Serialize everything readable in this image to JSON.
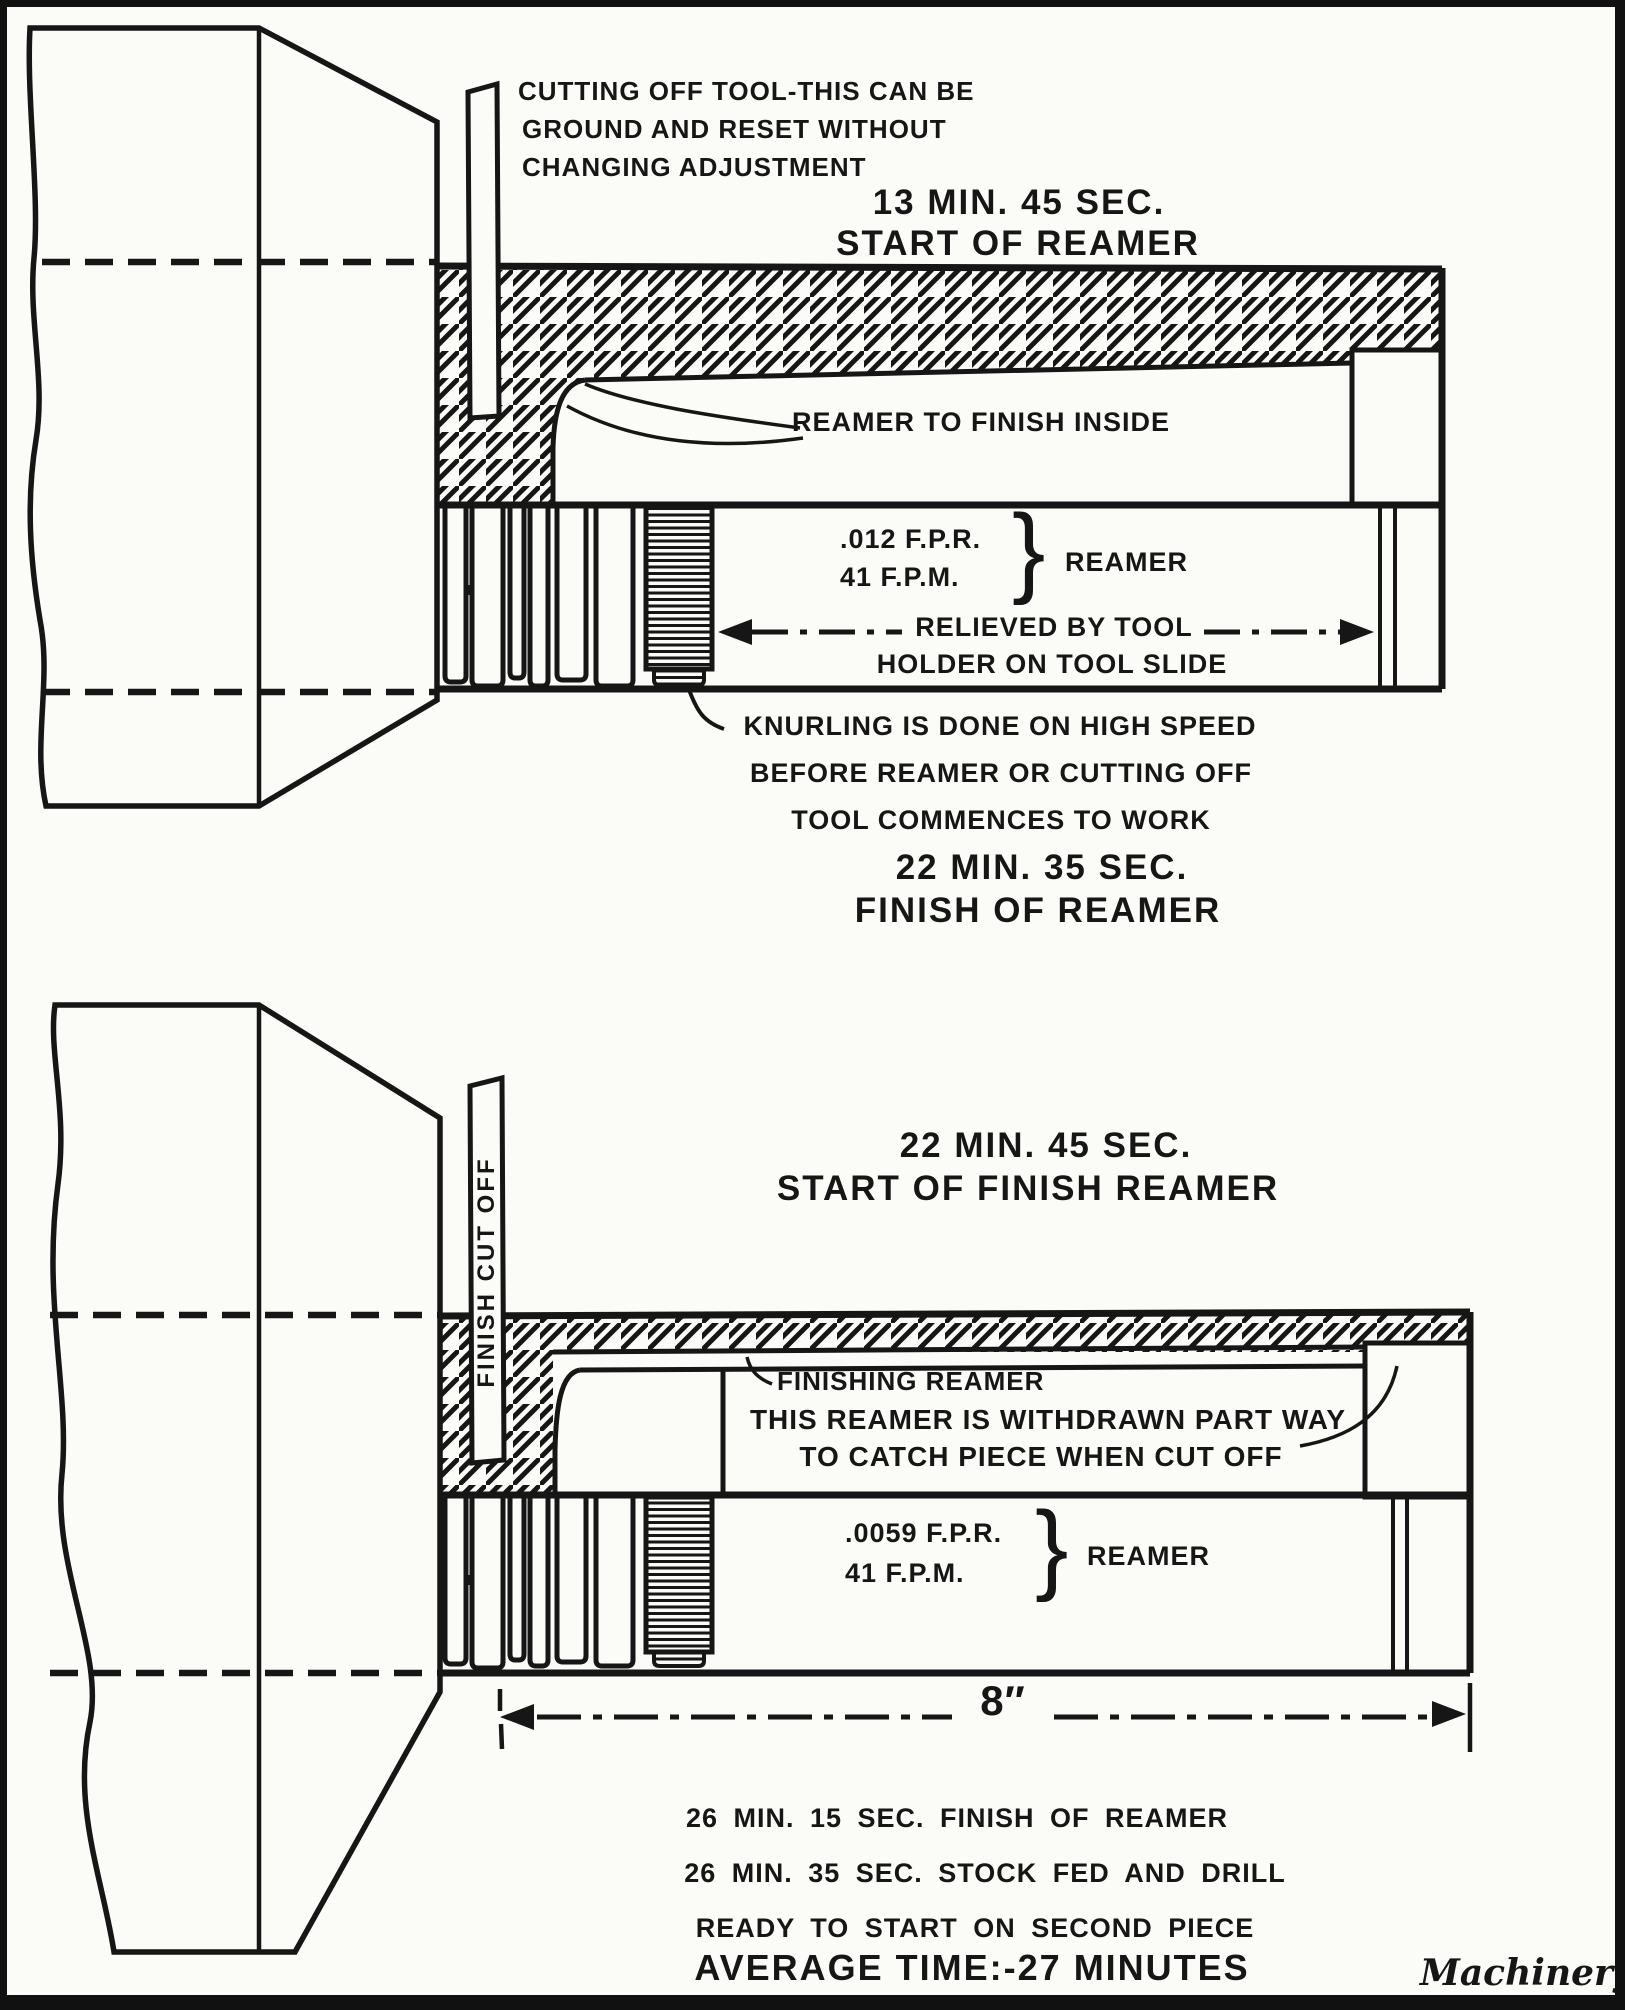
{
  "figure1": {
    "tool_note": [
      "CUTTING OFF TOOL-THIS CAN BE",
      "GROUND AND RESET WITHOUT",
      "CHANGING ADJUSTMENT"
    ],
    "time_start": [
      "13 MIN. 45 SEC.",
      "START OF REAMER"
    ],
    "reamer_inside": "REAMER TO FINISH INSIDE",
    "feed_rate": ".012 F.P.R.",
    "surface_speed": "41 F.P.M.",
    "brace": "}",
    "reamer_label": "REAMER",
    "relieved": [
      "RELIEVED BY TOOL",
      "HOLDER ON TOOL SLIDE"
    ],
    "knurling_note": [
      "KNURLING IS DONE ON HIGH SPEED",
      "BEFORE REAMER OR CUTTING OFF",
      "TOOL COMMENCES TO WORK"
    ],
    "time_finish": [
      "22 MIN. 35 SEC.",
      "FINISH OF REAMER"
    ]
  },
  "figure2": {
    "heading": [
      "22 MIN. 45 SEC.",
      "START OF FINISH REAMER"
    ],
    "cutoff_blade_label": "FINISH CUT OFF",
    "finishing_reamer_label": "FINISHING REAMER",
    "withdrawn_note": [
      "THIS REAMER IS WITHDRAWN PART WAY",
      "TO CATCH PIECE WHEN CUT OFF"
    ],
    "feed_rate": ".0059 F.P.R.",
    "surface_speed": "41 F.P.M.",
    "brace": "}",
    "reamer_label": "REAMER",
    "dimension": "8″",
    "schedule": [
      "26 MIN. 15 SEC. FINISH OF REAMER",
      "26 MIN. 35 SEC. STOCK FED AND DRILL",
      "READY TO START ON SECOND PIECE"
    ],
    "average_time": "AVERAGE TIME:-27 MINUTES"
  },
  "credit": "Machinery"
}
